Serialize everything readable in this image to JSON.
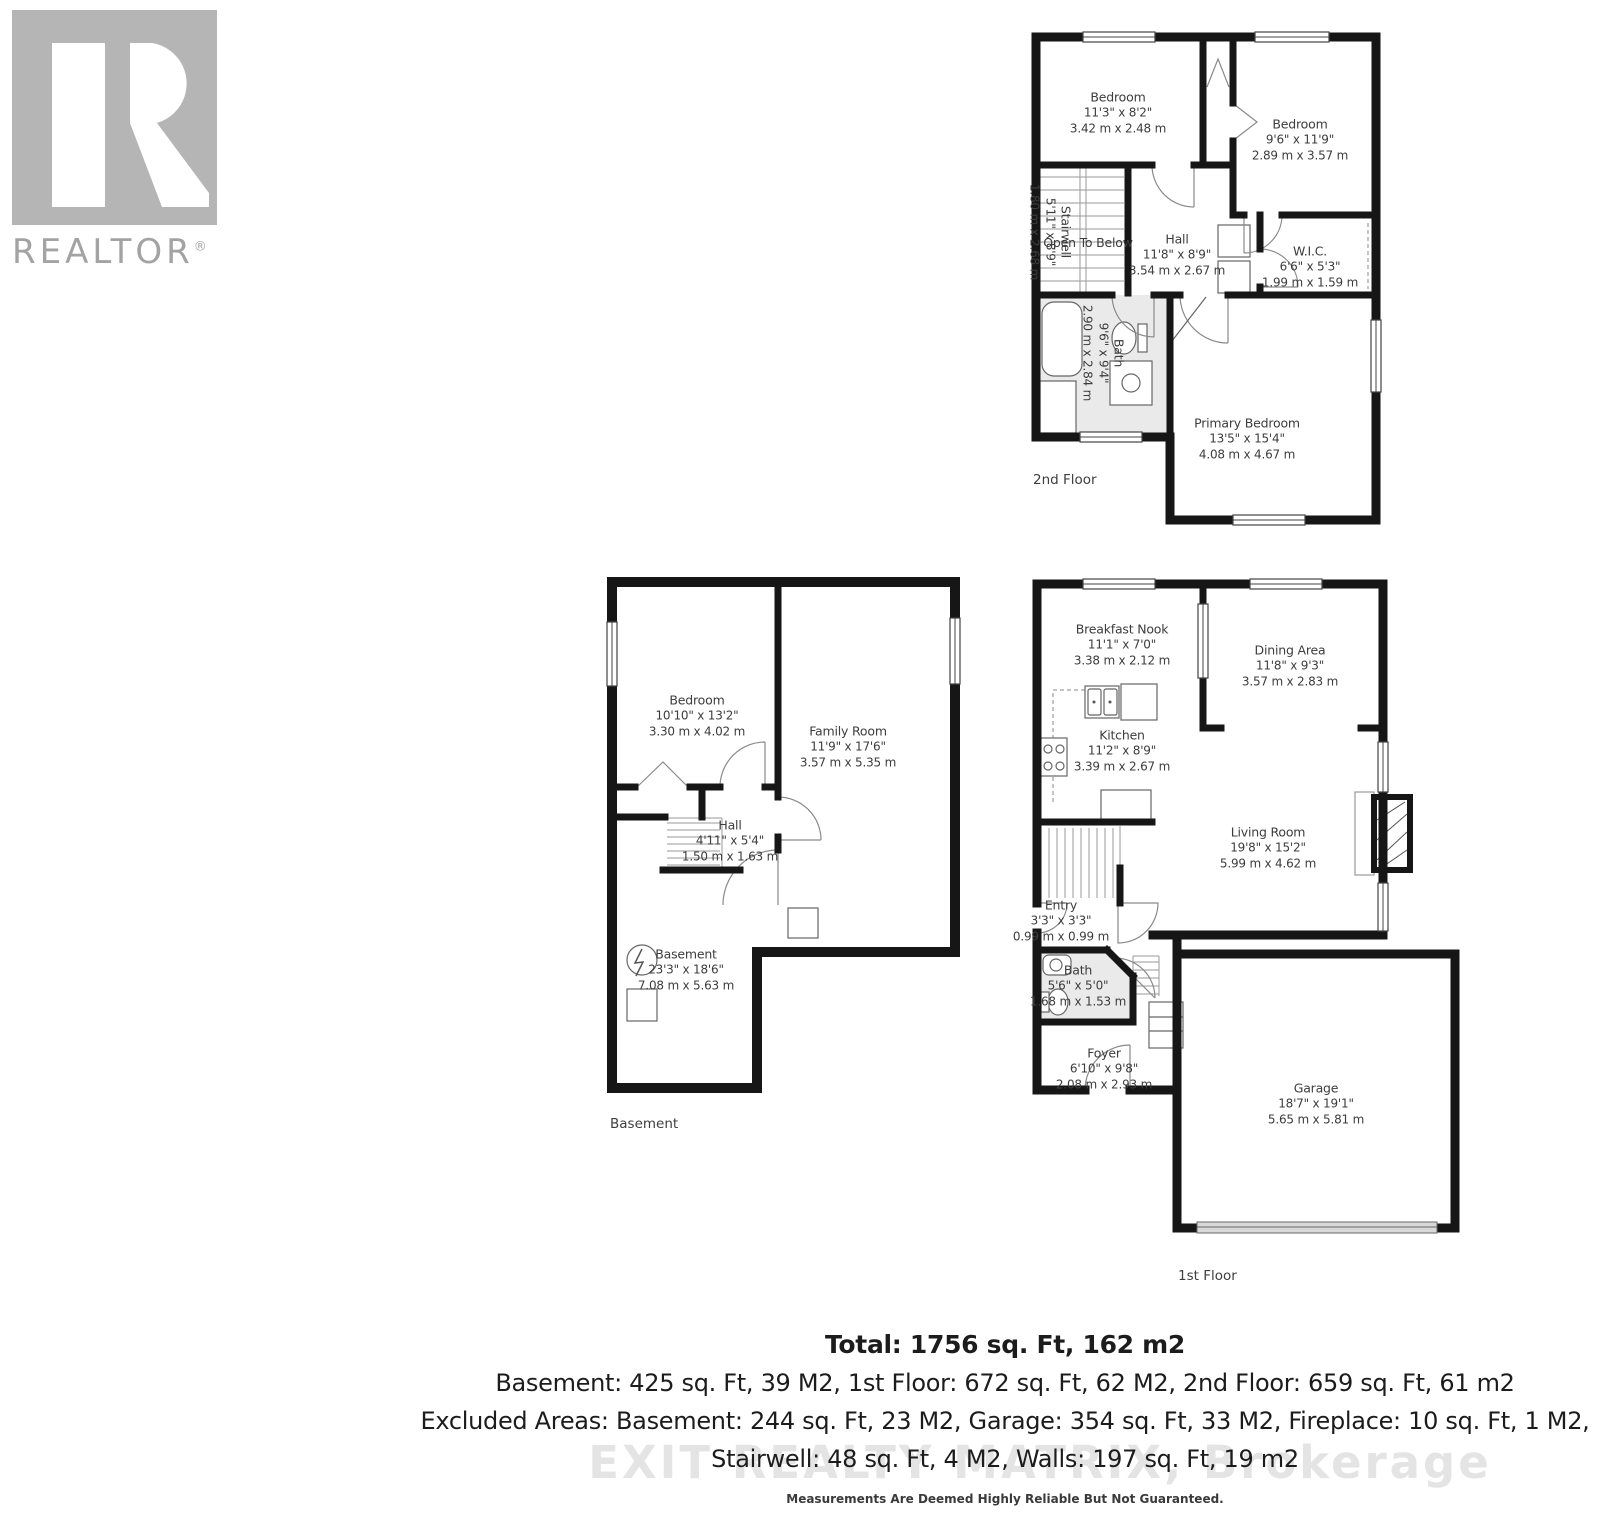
{
  "brand": {
    "realtor_wordmark": "REALTOR",
    "registered_symbol": "®"
  },
  "plans": {
    "second": {
      "floor_label": "2nd Floor",
      "rooms": {
        "bedroom_left": {
          "name": "Bedroom",
          "imperial": "11'3\" x 8'2\"",
          "metric": "3.42 m x 2.48 m"
        },
        "bedroom_right": {
          "name": "Bedroom",
          "imperial": "9'6\" x 11'9\"",
          "metric": "2.89 m x 3.57 m"
        },
        "stairwell": {
          "name": "Stairwell",
          "imperial": "5'11\" x 8'9\"",
          "metric": "1.80 m x 2.68 m"
        },
        "open_to_below": {
          "name": "Open To Below"
        },
        "hall": {
          "name": "Hall",
          "imperial": "11'8\" x 8'9\"",
          "metric": "3.54 m x 2.67 m"
        },
        "wic": {
          "name": "W.I.C.",
          "imperial": "6'6\" x 5'3\"",
          "metric": "1.99 m x 1.59 m"
        },
        "bath": {
          "name": "Bath",
          "imperial": "9'6\" x 9'4\"",
          "metric": "2.90 m x 2.84 m"
        },
        "primary_bedroom": {
          "name": "Primary Bedroom",
          "imperial": "13'5\" x 15'4\"",
          "metric": "4.08 m x 4.67 m"
        }
      }
    },
    "basement": {
      "floor_label": "Basement",
      "rooms": {
        "bedroom": {
          "name": "Bedroom",
          "imperial": "10'10\" x 13'2\"",
          "metric": "3.30 m x 4.02 m"
        },
        "family_room": {
          "name": "Family Room",
          "imperial": "11'9\" x 17'6\"",
          "metric": "3.57 m x 5.35 m"
        },
        "hall": {
          "name": "Hall",
          "imperial": "4'11\" x 5'4\"",
          "metric": "1.50 m x 1.63 m"
        },
        "basement": {
          "name": "Basement",
          "imperial": "23'3\" x 18'6\"",
          "metric": "7.08 m x 5.63 m"
        }
      }
    },
    "first": {
      "floor_label": "1st Floor",
      "rooms": {
        "breakfast_nook": {
          "name": "Breakfast Nook",
          "imperial": "11'1\" x 7'0\"",
          "metric": "3.38 m x 2.12 m"
        },
        "dining_area": {
          "name": "Dining Area",
          "imperial": "11'8\" x 9'3\"",
          "metric": "3.57 m x 2.83 m"
        },
        "kitchen": {
          "name": "Kitchen",
          "imperial": "11'2\" x 8'9\"",
          "metric": "3.39 m x 2.67 m"
        },
        "living_room": {
          "name": "Living Room",
          "imperial": "19'8\" x 15'2\"",
          "metric": "5.99 m x 4.62 m"
        },
        "entry": {
          "name": "Entry",
          "imperial": "3'3\" x 3'3\"",
          "metric": "0.99 m x 0.99 m"
        },
        "bath": {
          "name": "Bath",
          "imperial": "5'6\" x 5'0\"",
          "metric": "1.68 m x 1.53 m"
        },
        "foyer": {
          "name": "Foyer",
          "imperial": "6'10\" x 9'8\"",
          "metric": "2.08 m x 2.93 m"
        },
        "garage": {
          "name": "Garage",
          "imperial": "18'7\" x 19'1\"",
          "metric": "5.65 m x 5.81 m"
        }
      }
    }
  },
  "summary": {
    "total": "Total: 1756 sq. Ft, 162 m2",
    "line2": "Basement: 425 sq. Ft, 39 M2, 1st Floor: 672 sq. Ft, 62 M2, 2nd Floor: 659 sq. Ft, 61 m2",
    "line3": "Excluded Areas: Basement: 244 sq. Ft, 23 M2, Garage: 354 sq. Ft, 33 M2, Fireplace: 10 sq. Ft, 1 M2,",
    "line4": "Stairwell: 48 sq. Ft, 4 M2, Walls: 197 sq. Ft, 19 m2"
  },
  "watermark": "EXIT REALTY MATRIX, Brokerage",
  "disclaimer": "Measurements Are Deemed Highly Reliable But Not Guaranteed.",
  "colors": {
    "wall": "#161616",
    "bath_fill": "#eaeaea",
    "logo_gray": "#b5b5b5",
    "watermark_gray": "#e4e4e4"
  }
}
